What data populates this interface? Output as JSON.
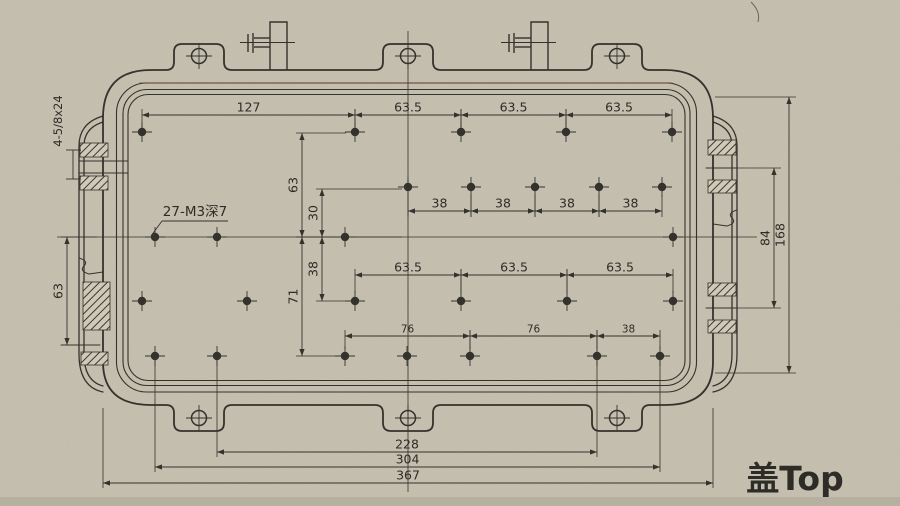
{
  "title": "盖Top",
  "notes": {
    "thread_note": "27-M3深7",
    "slot_note": "4-5/8x24"
  },
  "colors": {
    "paper": "#cfc9b8",
    "ink": "#34322c",
    "scan_tint": "#6e3a30"
  },
  "dimensions": {
    "horizontal": [
      {
        "label": "127",
        "x1": 142,
        "x2": 355,
        "y": 115,
        "ext": [
          -6,
          14
        ]
      },
      {
        "label": "63.5",
        "x1": 355,
        "x2": 461,
        "y": 115,
        "ext": [
          -6,
          14
        ]
      },
      {
        "label": "63.5",
        "x1": 461,
        "x2": 566,
        "y": 115,
        "ext": [
          -6,
          14
        ]
      },
      {
        "label": "63.5",
        "x1": 566,
        "x2": 672,
        "y": 115,
        "ext": [
          -6,
          14
        ]
      },
      {
        "label": "38",
        "x1": 408,
        "x2": 471,
        "y": 211,
        "ext": [
          6,
          -16
        ]
      },
      {
        "label": "38",
        "x1": 471,
        "x2": 535,
        "y": 211,
        "ext": [
          6,
          -16
        ]
      },
      {
        "label": "38",
        "x1": 535,
        "x2": 599,
        "y": 211,
        "ext": [
          6,
          -16
        ]
      },
      {
        "label": "38",
        "x1": 599,
        "x2": 662,
        "y": 211,
        "ext": [
          6,
          -16
        ]
      },
      {
        "label": "63.5",
        "x1": 355,
        "x2": 461,
        "y": 275,
        "ext": [
          -6,
          18
        ]
      },
      {
        "label": "63.5",
        "x1": 461,
        "x2": 567,
        "y": 275,
        "ext": [
          -6,
          18
        ]
      },
      {
        "label": "63.5",
        "x1": 567,
        "x2": 673,
        "y": 275,
        "ext": [
          -6,
          18
        ]
      },
      {
        "label": "76",
        "x1": 345,
        "x2": 470,
        "y": 336,
        "small": true,
        "ext": [
          -6,
          13
        ]
      },
      {
        "label": "76",
        "x1": 470,
        "x2": 597,
        "y": 336,
        "small": true,
        "ext": [
          -6,
          13
        ]
      },
      {
        "label": "38",
        "x1": 597,
        "x2": 660,
        "y": 336,
        "small": true,
        "ext": [
          -6,
          13
        ]
      },
      {
        "label": "228",
        "x1": 217,
        "x2": 597,
        "y": 452,
        "ext": [
          5,
          -92
        ]
      },
      {
        "label": "304",
        "x1": 155,
        "x2": 660,
        "y": 467,
        "ext": [
          5,
          -107
        ]
      },
      {
        "label": "367",
        "x1": 103,
        "x2": 713,
        "y": 483,
        "ext": [
          5,
          -75
        ]
      }
    ],
    "vertical": [
      {
        "label": "63",
        "x": 302,
        "y1": 133,
        "y2": 237,
        "ext": [
          -6,
          44
        ]
      },
      {
        "label": "71",
        "x": 302,
        "y1": 237,
        "y2": 356,
        "ext": [
          -6,
          40
        ]
      },
      {
        "label": "30",
        "x": 322,
        "y1": 189,
        "y2": 237,
        "ext": [
          -6,
          80
        ]
      },
      {
        "label": "38",
        "x": 322,
        "y1": 237,
        "y2": 301,
        "ext": [
          -6,
          26
        ]
      },
      {
        "label": "63",
        "x": 67,
        "y1": 237,
        "y2": 345,
        "ext": [
          -6,
          30
        ]
      },
      {
        "label": "84",
        "x": 774,
        "y1": 168,
        "y2": 308,
        "ext": [
          -66,
          7
        ]
      },
      {
        "label": "168",
        "x": 789,
        "y1": 97,
        "y2": 373,
        "ext": [
          -74,
          7
        ]
      }
    ]
  },
  "holes": {
    "thread_size": "M3",
    "count": 27,
    "grid_rows": [
      {
        "y": 132,
        "xs": [
          142,
          355,
          461,
          566,
          672
        ]
      },
      {
        "y": 187,
        "xs": [
          408,
          471,
          535,
          599,
          662
        ]
      },
      {
        "y": 237,
        "xs": [
          155,
          217,
          345,
          673
        ]
      },
      {
        "y": 301,
        "xs": [
          142,
          247,
          355,
          461,
          567,
          673
        ]
      },
      {
        "y": 356,
        "xs": [
          155,
          217,
          345,
          407,
          470,
          597,
          660
        ]
      }
    ],
    "tab_holes": [
      {
        "x": 199,
        "y": 56
      },
      {
        "x": 408,
        "y": 56
      },
      {
        "x": 617,
        "y": 56
      },
      {
        "x": 199,
        "y": 418
      },
      {
        "x": 408,
        "y": 418
      },
      {
        "x": 617,
        "y": 418
      }
    ]
  },
  "centerlines": {
    "horizontal": {
      "y": 237,
      "x1": 57,
      "x2": 757
    },
    "vertical": {
      "x": 408,
      "y1": 31,
      "y2": 492
    }
  }
}
